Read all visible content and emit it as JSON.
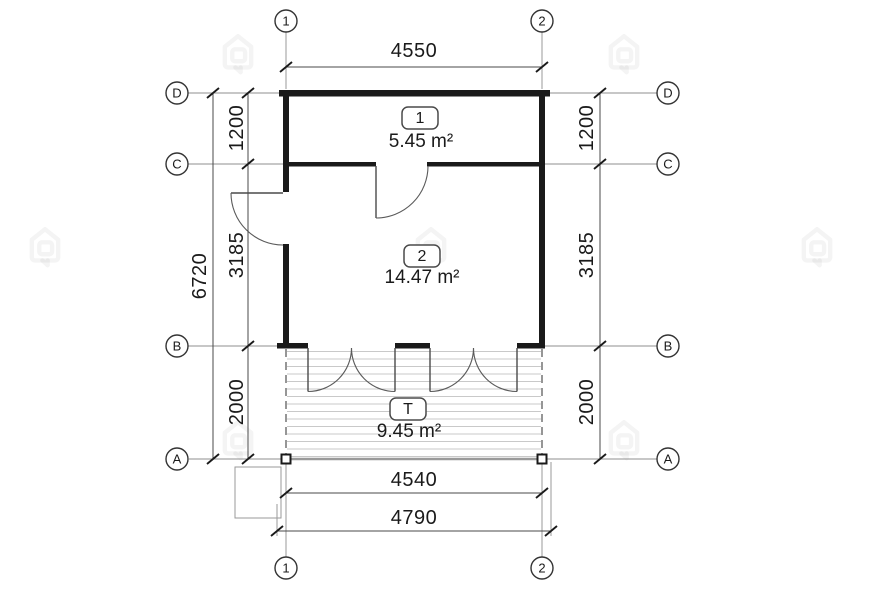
{
  "drawing": {
    "title": "floor-plan",
    "grid": {
      "cols": [
        "1",
        "2"
      ],
      "rows": [
        "D",
        "C",
        "B",
        "A"
      ]
    },
    "dimensions": {
      "top_width": "4550",
      "left_total": "6720",
      "left_segments": [
        "1200",
        "3185",
        "2000"
      ],
      "right_segments": [
        "1200",
        "3185",
        "2000"
      ],
      "bottom_inner": "4540",
      "bottom_outer": "4790"
    },
    "rooms": [
      {
        "number": "1",
        "area": "5.45 m²"
      },
      {
        "number": "2",
        "area": "14.47 m²"
      },
      {
        "number": "T",
        "area": "9.45 m²"
      }
    ],
    "colors": {
      "wall": "#1a1a1a",
      "dimension_line": "#4a4a4a",
      "grid_line": "#8f8f8f",
      "decking": "#c9c9c9",
      "text": "#1a1a1a",
      "watermark": "#ebebeb",
      "background": "#ffffff"
    },
    "watermark": {
      "name": "house-logo"
    }
  }
}
